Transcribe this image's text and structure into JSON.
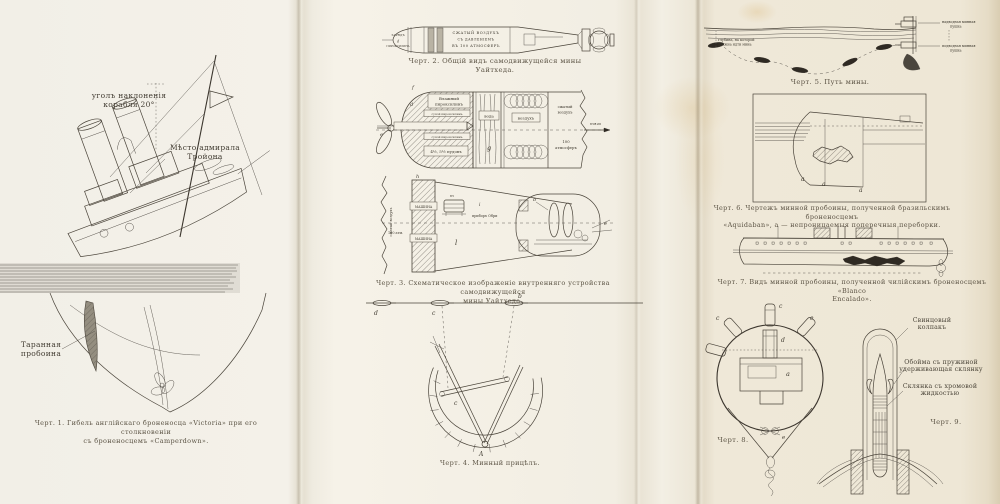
{
  "plate": {
    "fig1": {
      "caption": [
        "Черт. 1. Гибель англійскаго броненосца «Victoria» при его столкновеніи",
        "съ броненосцемъ «Camperdown»."
      ],
      "incline": [
        "уголъ наклоненія",
        "корабля 20°"
      ],
      "admiral": [
        "Мѣсто адмирала",
        "Тройона"
      ],
      "ram": [
        "Таранная",
        "пробоина"
      ]
    },
    "fig2": {
      "caption": "Черт. 2. Общій видъ самодвижущейся мины Уайтхеда.",
      "head": [
        "ЗАРЯДЪ",
        "ПИРОКСИЛИНА"
      ],
      "body": [
        "СЖАТЫЙ ВОЗДУХЪ",
        "СЪ ДАВЛЕНІЕМЪ",
        "ВЪ 100 АТМОСФЕРЪ"
      ]
    },
    "fig3": {
      "caption": [
        "Черт. 3. Схематическое изображеніе внутренняго устройства самодвижущейся",
        "мины Уайтхеда."
      ],
      "wet": [
        "Влажный",
        "пироксилинъ"
      ],
      "dry1": "сухой пироксилинъ",
      "dry2": "сухой пироксилинъ",
      "weight": "4½, 5½ пудовъ",
      "water": "вода",
      "air": "воздухъ",
      "compressed": [
        "сжатый",
        "воздухъ"
      ],
      "atm": [
        "100",
        "атмосферъ"
      ],
      "thrust": "тяга",
      "left_air": "сжатый воздухъ",
      "left_atm": "100 атм.",
      "machine1": "МАШИНА",
      "machine2": "МАШИНА",
      "obry": "приборъ Обри",
      "letters": {
        "d": "d",
        "e": "e",
        "f": "f",
        "g": "g",
        "h": "h",
        "i": "i",
        "l": "l",
        "b": "b",
        "e2": "e",
        "m": "m"
      }
    },
    "fig4": {
      "caption": "Черт. 4. Минный прицѣлъ.",
      "letters": {
        "t1": "d",
        "t2": "c",
        "t3": "b",
        "pivot": "A",
        "arm": "c"
      }
    },
    "fig5": {
      "caption": "Черт. 5. Путь мины.",
      "depth": [
        "глубина, на которой",
        "должна идти мина"
      ],
      "above": [
        "надводная минная",
        "пушка"
      ],
      "below": [
        "подводная минная",
        "пушка"
      ]
    },
    "fig6": {
      "caption": [
        "Черт. 6. Чертежъ минной пробоины, полученной бразильскимъ броненосцемъ",
        "«Aquidaban», a — непроницаемыя поперечныя переборки."
      ],
      "letters": [
        "a",
        "a",
        "a"
      ]
    },
    "fig7": {
      "caption": [
        "Черт. 7. Видъ минной пробоины, полученной чилійскимъ броненосцемъ «Blanco",
        "Encalado»."
      ]
    },
    "fig8": {
      "caption": "Черт. 8.",
      "letters": {
        "top": "c",
        "left": "c",
        "right": "e",
        "det": "d",
        "body": "a",
        "shackle": "e"
      }
    },
    "fig9": {
      "caption": "Черт. 9.",
      "cap": [
        "Свинцовый",
        "колпакъ"
      ],
      "clip": [
        "Обойма съ пружиной",
        "удерживающая склянку"
      ],
      "vial": [
        "Склянка съ хромовой",
        "жидкостью"
      ]
    }
  }
}
